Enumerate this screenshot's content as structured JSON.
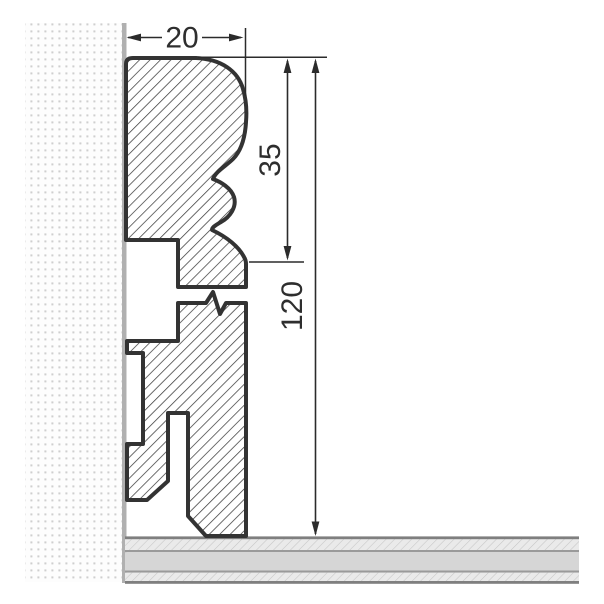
{
  "drawing": {
    "title": "Skirting board profile cross-section",
    "view": "side section of moulded skirting mounted on wall above floor"
  },
  "dims": {
    "width": "20",
    "upper_height": "35",
    "total_height": "120"
  },
  "colors": {
    "outline": "#333333",
    "hatch_line": "#3c3c3c",
    "dimension": "#2b2b2b",
    "text": "#2e2e2e",
    "wall_surface": "#b0b0b0",
    "wall_dot": "#cfcfcf",
    "floor_hatch_bg": "#eaeaea",
    "floor_hatch_line": "#c6c6c6",
    "floor_mid": "#d6d6d6",
    "floor_separator": "#9a9a9a",
    "floor_edge": "#7f7f7f",
    "background": "#ffffff"
  }
}
